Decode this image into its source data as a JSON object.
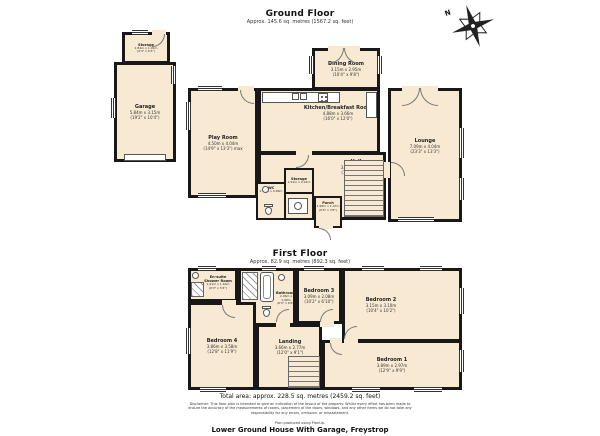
{
  "page": {
    "compass_label": "N",
    "total_area_line": "Total area: approx. 228.5 sq. metres (2459.2 sq. feet)",
    "disclaimer": "Disclaimer: This floor plan is intended to give an indication of the layout of the property. Whilst every effort has been made to ensure the accuracy of the measurements of rooms, placement of the doors, windows, and any other items we do not take any responsibility for any errors, omission, or misstatement.",
    "produced_by": "Plan produced using PlanUp.",
    "property_title": "Lower Ground House With Garage, Freystrop"
  },
  "ground_floor": {
    "title": "Ground Floor",
    "subtitle": "Approx. 145.6 sq. metres (1567.2 sq. feet)",
    "rooms": {
      "storage": {
        "name": "Storage",
        "dims": "2.84m x 1.91m",
        "dims_ft": "(9'4\" x 6'3\")"
      },
      "garage": {
        "name": "Garage",
        "dims": "5.84m x 3.15m",
        "dims_ft": "(19'2\" x 10'4\")"
      },
      "play_room": {
        "name": "Play Room",
        "dims": "4.50m x 4.04m",
        "dims_ft": "(14'9\" x 13'3\") max"
      },
      "dining_room": {
        "name": "Dining Room",
        "dims": "3.15m x 2.95m",
        "dims_ft": "(10'4\" x 9'8\")"
      },
      "kitchen": {
        "name": "Kitchen/Breakfast Room",
        "dims": "4.88m x 3.66m",
        "dims_ft": "(16'0\" x 12'0\")"
      },
      "lounge": {
        "name": "Lounge",
        "dims": "7.09m x 4.04m",
        "dims_ft": "(23'3\" x 13'3\")"
      },
      "hall": {
        "name": "Hall",
        "dims": "3.30m x 2.90m",
        "dims_ft": "(10'10\" x 9'6\")"
      },
      "wc": {
        "name": "WC",
        "dims": "1.70m x 0.89m",
        "dims_ft": "(5'7\" x 2'11\")"
      },
      "inner_storage": {
        "name": "Storage",
        "dims": "1.52m x 0.91m",
        "dims_ft": "(5'0\" x 3'0\")"
      },
      "porch": {
        "name": "Porch",
        "dims": "1.98m x 1.07m",
        "dims_ft": "(6'6\" x 3'6\")"
      }
    }
  },
  "first_floor": {
    "title": "First Floor",
    "subtitle": "Approx. 82.9 sq. metres (892.3 sq. feet)",
    "rooms": {
      "ensuite": {
        "name": "En-suite Shower Room",
        "dims": "1.91m x 1.63m",
        "dims_ft": "(6'3\" x 5'4\")"
      },
      "bathroom": {
        "name": "Bathroom",
        "dims": "2.06m x 1.98m",
        "dims_ft": "(6'9\" x 6'6\")"
      },
      "bedroom_3": {
        "name": "Bedroom 3",
        "dims": "3.09m x 2.08m",
        "dims_ft": "(10'2\" x 6'10\")"
      },
      "bedroom_2": {
        "name": "Bedroom 2",
        "dims": "3.15m x 3.10m",
        "dims_ft": "(10'4\" x 10'2\")"
      },
      "bedroom_4": {
        "name": "Bedroom 4",
        "dims": "3.86m x 3.58m",
        "dims_ft": "(12'8\" x 11'9\")"
      },
      "landing": {
        "name": "Landing",
        "dims": "3.66m x 2.77m",
        "dims_ft": "(12'0\" x 9'1\")"
      },
      "bedroom_1": {
        "name": "Bedroom 1",
        "dims": "3.89m x 2.97m",
        "dims_ft": "(12'9\" x 9'9\")"
      }
    }
  }
}
